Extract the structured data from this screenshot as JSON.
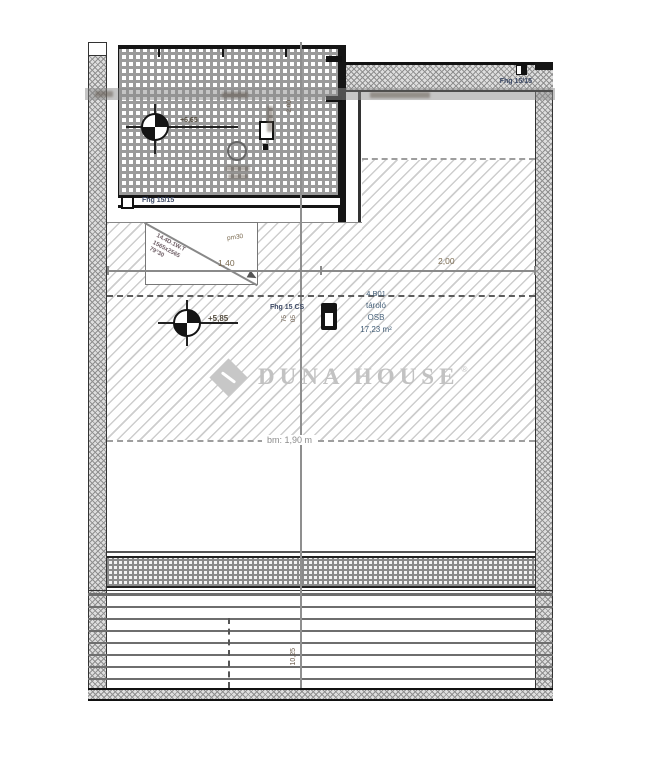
{
  "brand": {
    "watermark": "DUNA HOUSE",
    "registered": "®"
  },
  "room": {
    "code": "4.B01",
    "name": "tároló",
    "floor_material": "OSB",
    "area": "17,23 m²",
    "clear_height_line": "bm: 1,90 m"
  },
  "levels": {
    "terrace_marker": "+6,65",
    "attic_marker": "+5,85"
  },
  "dimensions": {
    "span_left": "1,40",
    "span_right": "2,00",
    "terrace_vertical": "2,00",
    "bottom_vertical": "10,25",
    "door_dim_a": "75",
    "door_dim_b": "05"
  },
  "structure": {
    "beam_terrace": "Fhg 15/15",
    "beam_top_right": "Fhg 15/15",
    "beam_door": "Fhg 15 CS",
    "roof_window": [
      "14.4D.1W.T",
      "1565x2565",
      "79°30"
    ],
    "note_pm": "pm30"
  },
  "colors": {
    "watermark_grey": "#c2c2c2",
    "label_blue": "#3d4a66",
    "dimension_brown": "#7a6a50",
    "hatch_grey": "#9a9a9a",
    "wall_black": "#151515"
  }
}
